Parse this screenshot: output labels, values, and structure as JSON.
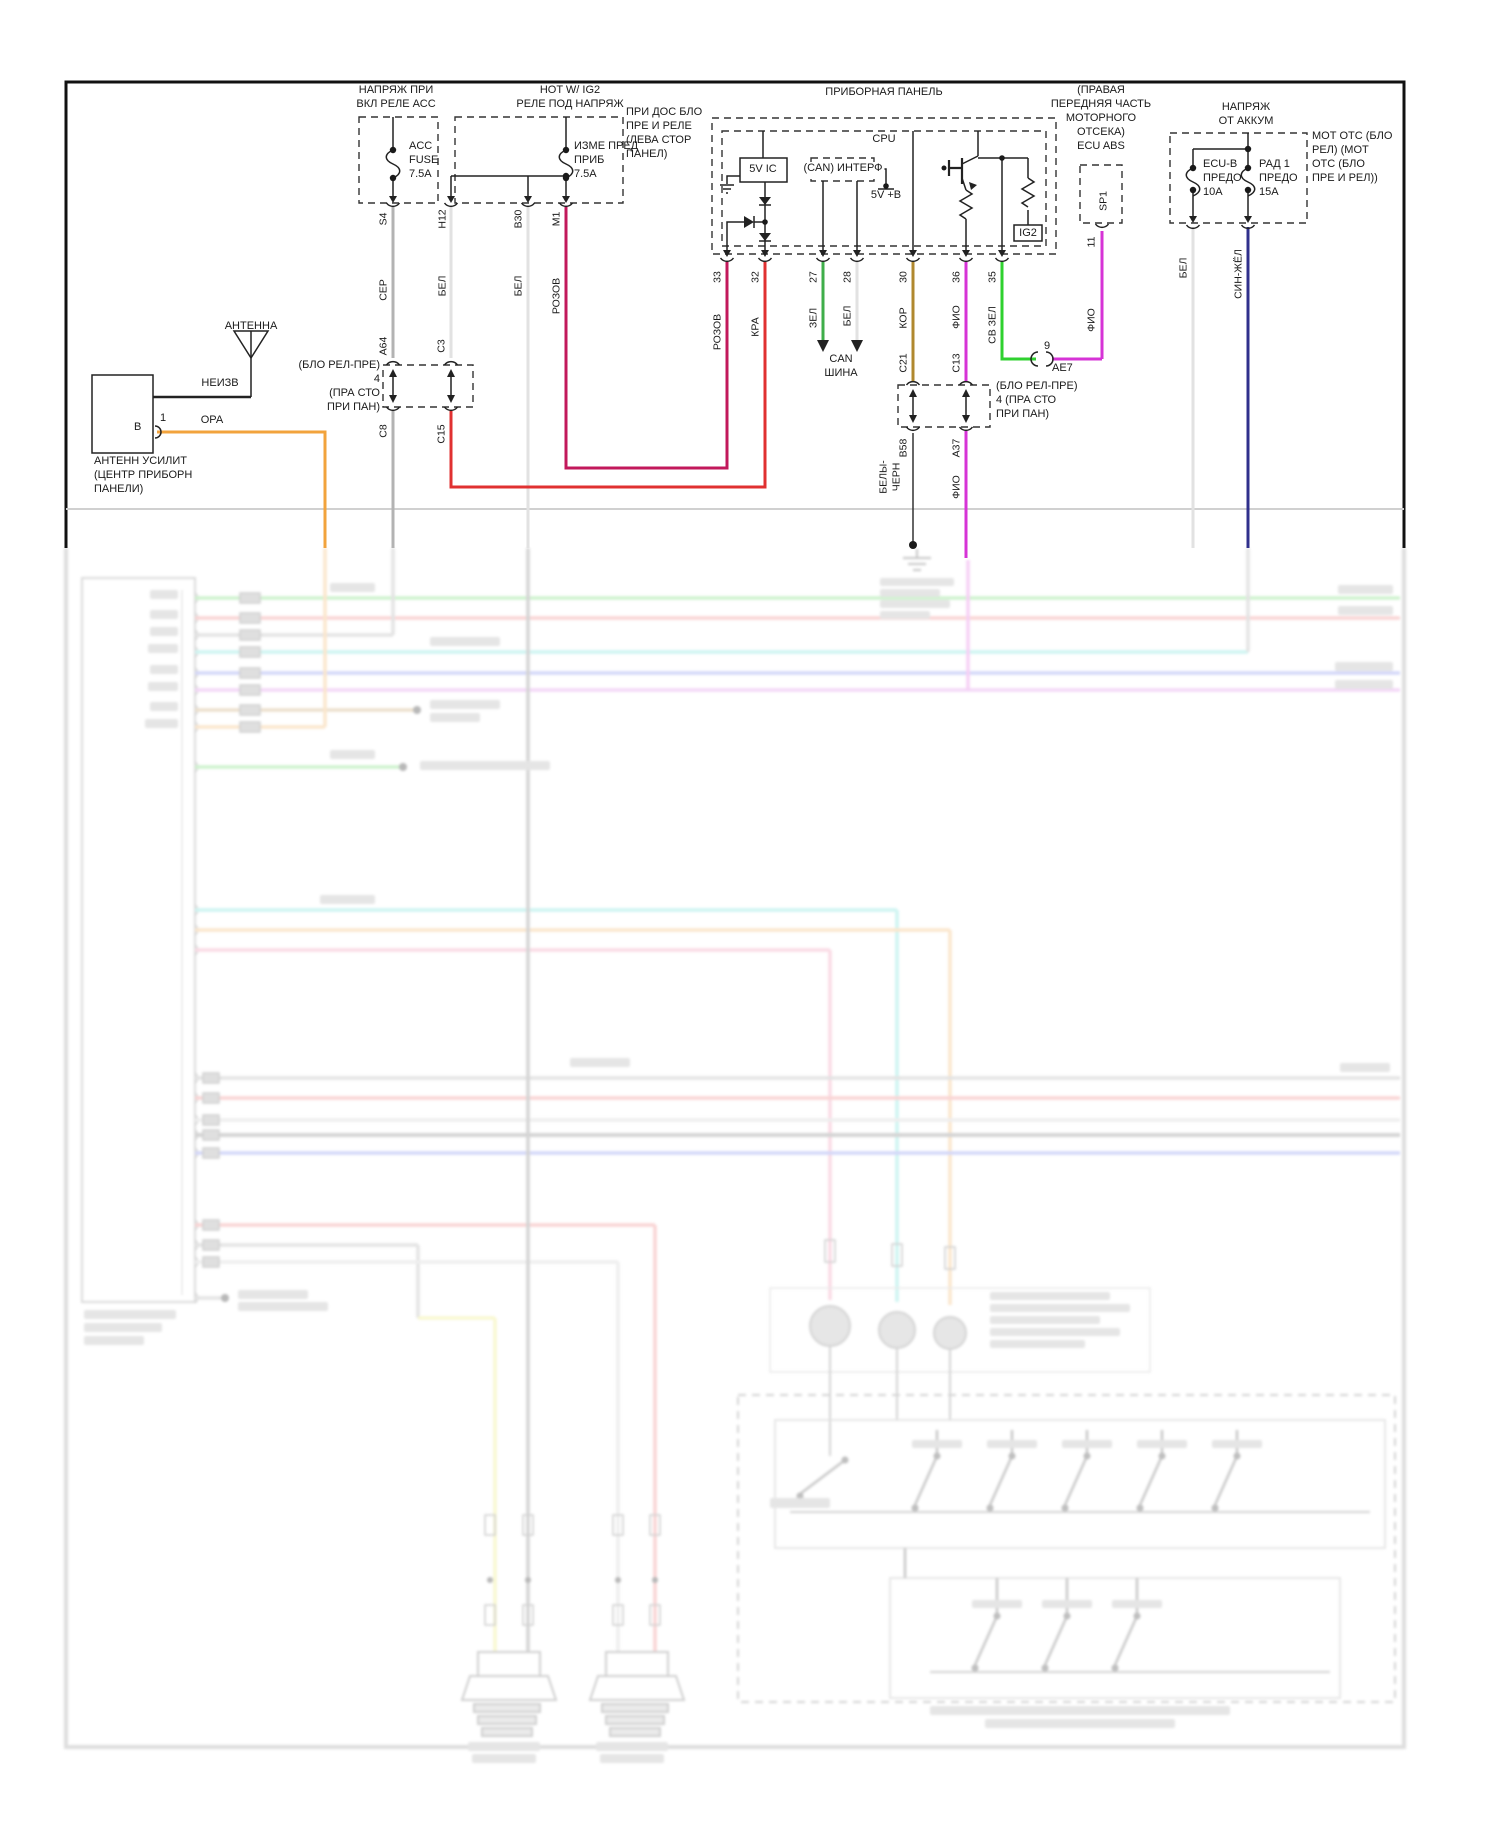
{
  "labels": {
    "acc_title": "НАПРЯЖ ПРИ\nВКЛ РЕЛЕ АСС",
    "acc_fuse": "ACC\nFUSE\n7.5A",
    "ig2_title": "HOT W/ IG2\nРЕЛЕ ПОД НАПРЯЖ",
    "ig2_fuse": "ИЗМЕ ПРЕД\nПРИБ\n7.5A",
    "ig2_note": "ПРИ ДОС БЛО\nПРЕ И РЕЛЕ\n(ЛЕВА СТОР\nПАНЕЛ)",
    "panel_title": "ПРИБОРНАЯ ПАНЕЛЬ",
    "cpu": "CPU",
    "ic5v": "5V IC",
    "can_if": "(CAN) ИНТЕРФ",
    "v5b": "5V +B",
    "ig2_box": "IG2",
    "ecu_abs_title": "(ПРАВАЯ\nПЕРЕДНЯЯ ЧАСТЬ\nМОТОРНОГО\nОТСЕКА)\nECU ABS",
    "batt_title": "НАПРЯЖ\nОТ АККУМ",
    "fuse_ecub": "ECU-B\nПРЕДО\n10A",
    "fuse_rad": "РАД 1\nПРЕДО\n15A",
    "batt_note": "МОТ ОТС (БЛО\nРЕЛ) (МОТ\nОТС (БЛО\nПРЕ И РЕЛ))",
    "antenna": "АНТЕННА",
    "amp_caption": "АНТЕНН УСИЛИТ\n(ЦЕНТР ПРИБОРН\nПАНЕЛИ)",
    "conn_left": "(БЛО РЕЛ-ПРЕ)\n4\n(ПРА СТО\nПРИ ПАН)",
    "conn_mid": "(БЛО РЕЛ-ПРЕ)\n4 (ПРА СТО\nПРИ ПАН)",
    "can_bus": "CAN\nШИНА"
  },
  "pins": {
    "s4": "S4",
    "h12": "H12",
    "b30": "B30",
    "m1": "M1",
    "a64": "A64",
    "c3": "C3",
    "c8": "C8",
    "c15": "C15",
    "n33": "33",
    "n32": "32",
    "n27": "27",
    "n28": "28",
    "n30": "30",
    "n36": "36",
    "n35": "35",
    "c21": "C21",
    "c13": "C13",
    "b58": "B58",
    "a37": "A37",
    "sp1": "SP1",
    "n11": "11",
    "n9": "9",
    "ae7": "АЕ7",
    "amp_b": "В",
    "amp_1": "1",
    "ig2": "IG2"
  },
  "wires": {
    "ser": "СЕР",
    "bel": "БЕЛ",
    "rozov": "РОЗОВ",
    "kra": "КРА",
    "zel": "ЗЕЛ",
    "kor": "КОР",
    "fio": "ФИО",
    "svzel": "СВ ЗЕЛ",
    "sinzhel": "СИН-ЖЁЛ",
    "belychern": "БЕЛЫ-\nЧЕРН",
    "ora": "ОРА",
    "neizv": "НЕИЗВ"
  },
  "colors": {
    "black": "#1a1a1a",
    "ser": "#b3b3b3",
    "bel": "#e2e2e2",
    "rozov": "#c2185b",
    "kra": "#e03131",
    "zel": "#3fae4a",
    "svzel": "#2fd12f",
    "kor": "#b0882e",
    "fio": "#d633d6",
    "sinzhel": "#30308c",
    "ora": "#f2a33c",
    "f_green": "#8ce08c",
    "f_red": "#f19999",
    "f_gray": "#bdbdbd",
    "f_cyan": "#8ae6df",
    "f_blue": "#97a0ef",
    "f_violet": "#e4a0ed",
    "f_tan": "#d2b588",
    "f_orange": "#f5c488",
    "f_yellow": "#f0ee90",
    "f_dgray": "#9a9a9a",
    "f_lgray": "#d8d8d8",
    "f_pink": "#f3a8c0",
    "f_magenta": "#ea8fe8"
  }
}
